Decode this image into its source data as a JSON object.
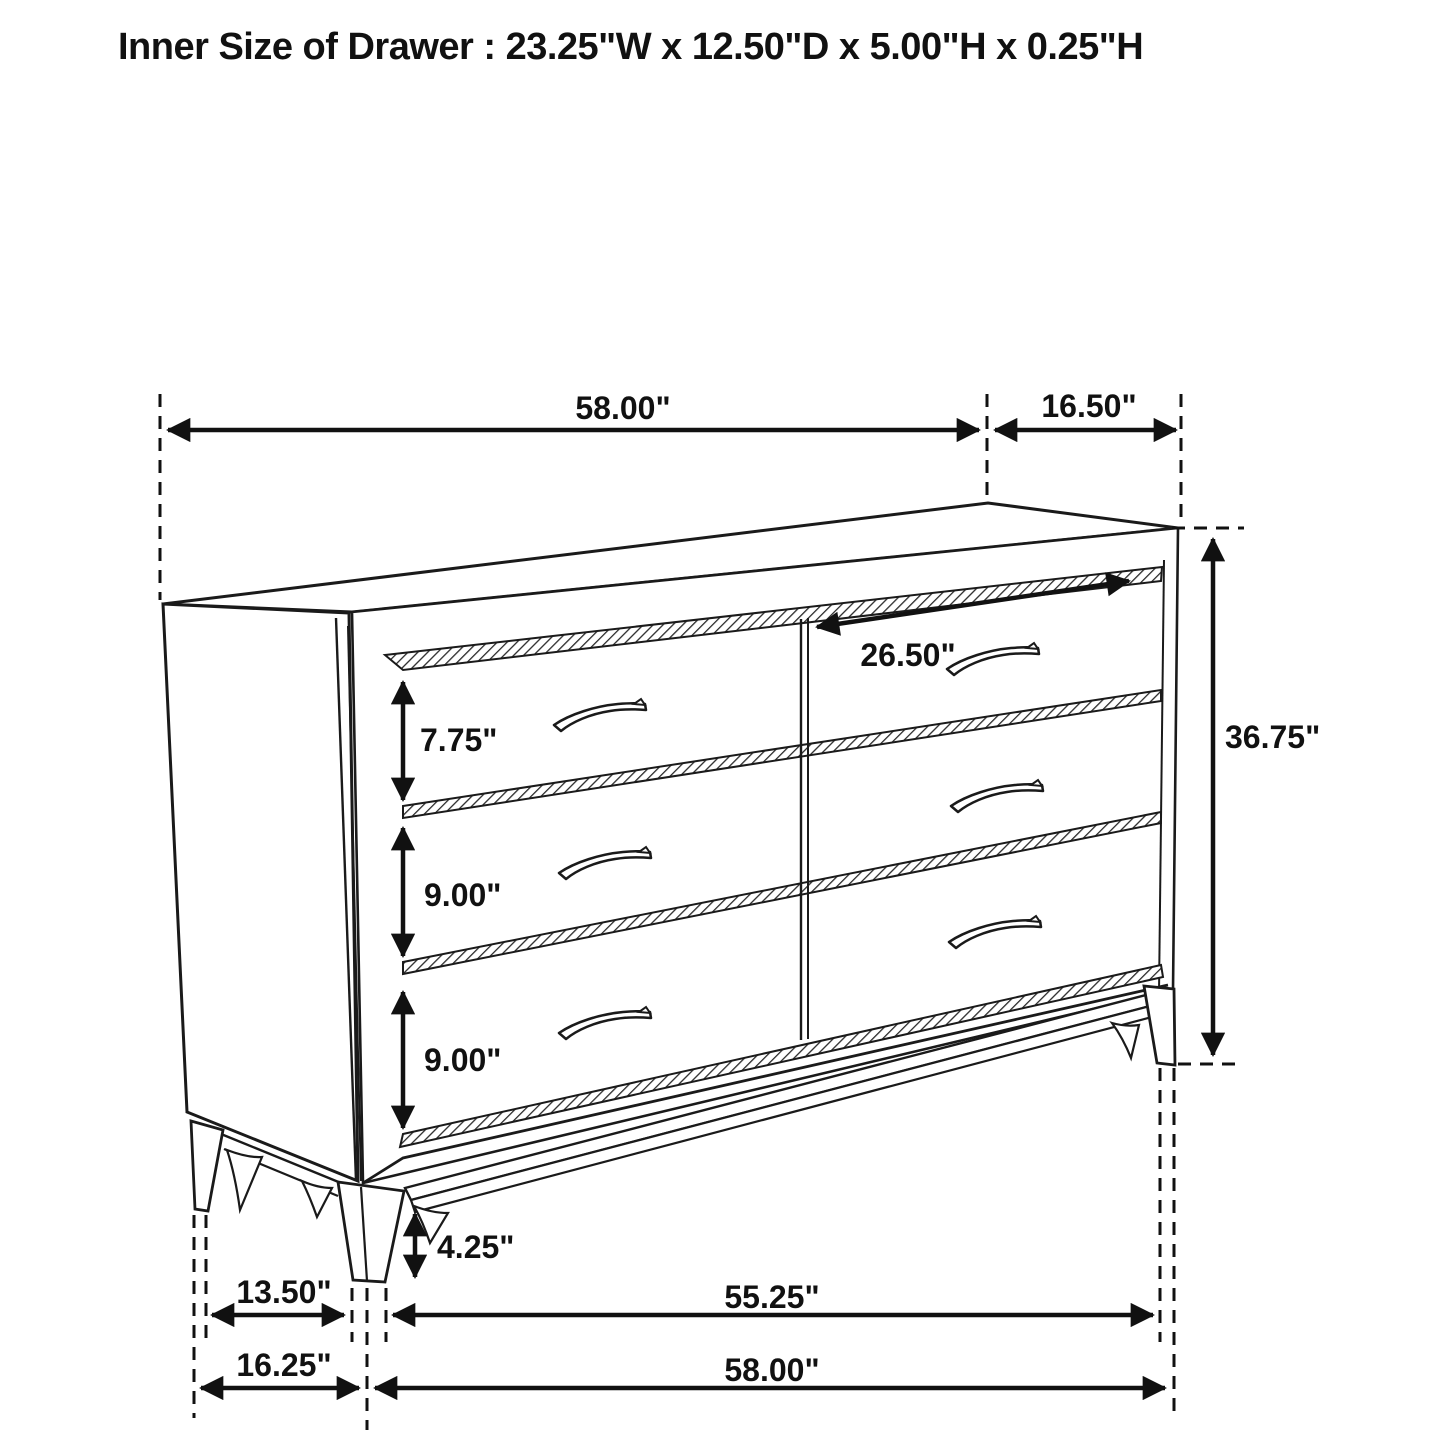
{
  "title": "Inner Size of Drawer : 23.25\"W x 12.50\"D x 5.00\"H x 0.25\"H",
  "figure": {
    "subject": "six-drawer dresser",
    "style": "black line perspective dimension diagram"
  },
  "dims": {
    "top_width": "58.00\"",
    "top_depth": "16.50\"",
    "drawer_width": "26.50\"",
    "drawer1_height": "7.75\"",
    "drawer2_height": "9.00\"",
    "drawer3_height": "9.00\"",
    "overall_height": "36.75\"",
    "leg_height": "4.25\"",
    "base_depth_inner": "13.50\"",
    "base_width_inner": "55.25\"",
    "base_depth_outer": "16.25\"",
    "base_width_outer": "58.00\""
  },
  "inner_drawer_size": {
    "width": "23.25\"",
    "depth": "12.50\"",
    "height": "5.00\"",
    "wall_thickness": "0.25\""
  },
  "colors": {
    "line": "#1a1a1a",
    "dimension": "#111111",
    "background": "#ffffff"
  }
}
